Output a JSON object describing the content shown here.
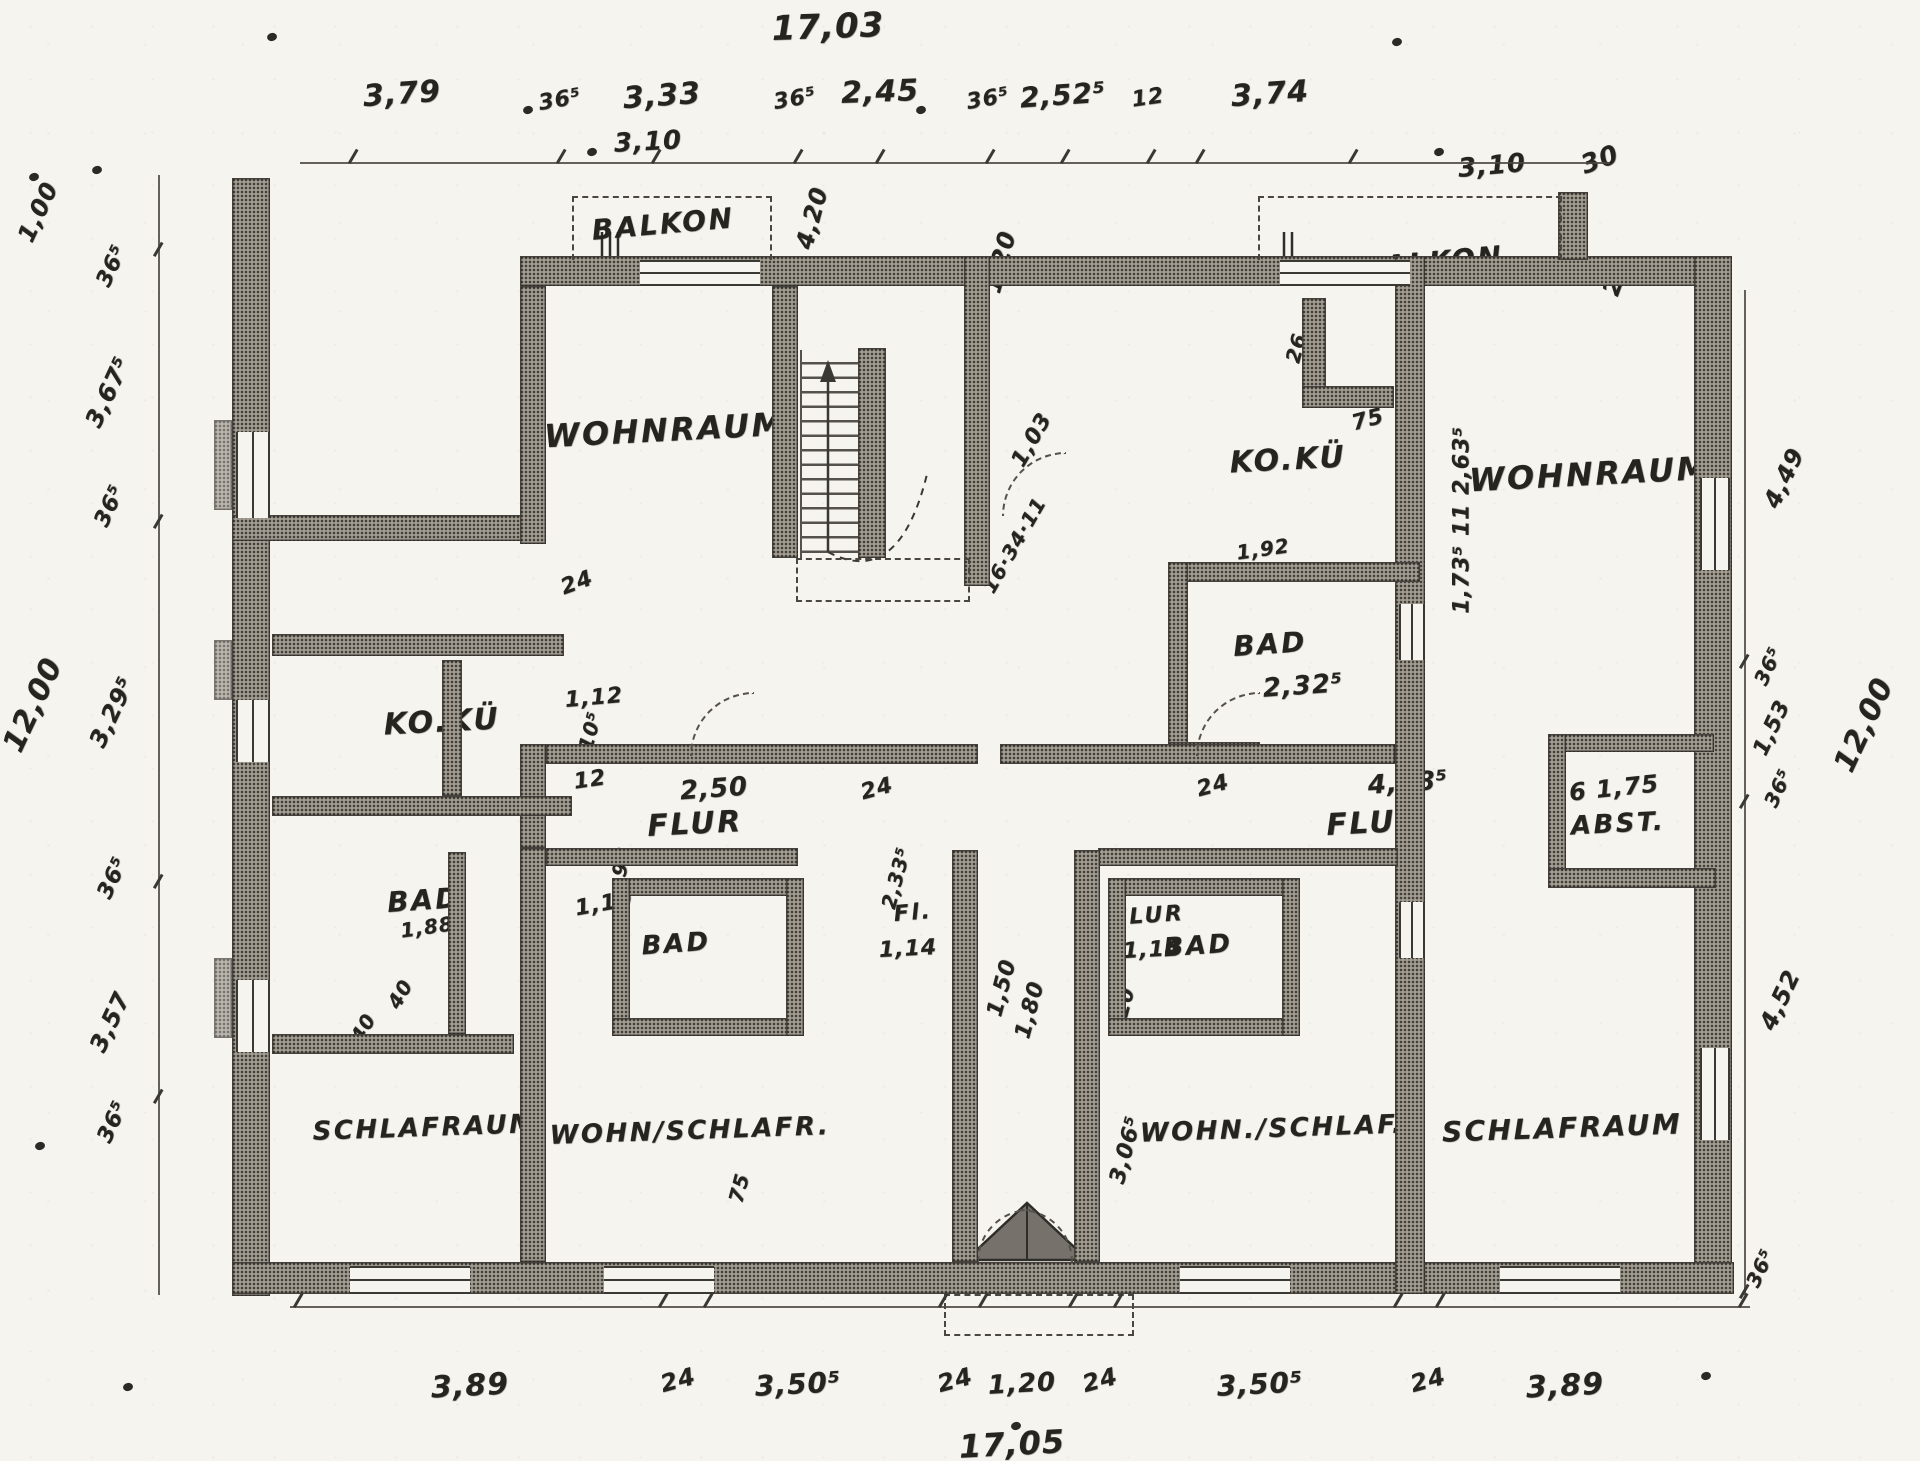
{
  "colors": {
    "ink": "#26241f",
    "paper": "#f6f4ef",
    "wall_fill": "#a39d92"
  },
  "plan": {
    "overall_width_top": "17,03",
    "overall_width_bottom": "17,05",
    "overall_depth_left": "12,00",
    "overall_depth_right": "12,00"
  },
  "rooms": [
    {
      "name": "room-label-balkon-left",
      "text": "BALKON",
      "x": 663,
      "y": 224,
      "fs": 28,
      "rot": -5
    },
    {
      "name": "room-label-balkon-right",
      "text": "BALKON",
      "x": 1432,
      "y": 262,
      "fs": 28,
      "rot": -5
    },
    {
      "name": "room-label-wohnraum-left",
      "text": "WOHNRAUM",
      "x": 665,
      "y": 430,
      "fs": 32,
      "rot": -3
    },
    {
      "name": "room-label-ko-ku-right",
      "text": "KO.KÜ",
      "x": 1288,
      "y": 460,
      "fs": 30,
      "rot": -3
    },
    {
      "name": "room-label-wohnraum-right",
      "text": "WOHNRAUM",
      "x": 1590,
      "y": 474,
      "fs": 32,
      "rot": -3
    },
    {
      "name": "room-label-ko-ku-left",
      "text": "KO.KÜ",
      "x": 442,
      "y": 722,
      "fs": 30,
      "rot": -3
    },
    {
      "name": "room-label-bad-right",
      "text": "BAD",
      "x": 1270,
      "y": 644,
      "fs": 28,
      "rot": -4
    },
    {
      "name": "room-label-bad-left",
      "text": "BAD",
      "x": 424,
      "y": 900,
      "fs": 28,
      "rot": -4
    },
    {
      "name": "room-label-flur-left",
      "text": "FLUR",
      "x": 695,
      "y": 824,
      "fs": 30,
      "rot": -3
    },
    {
      "name": "room-label-flur-right",
      "text": "FLUR",
      "x": 1374,
      "y": 823,
      "fs": 30,
      "rot": -3
    },
    {
      "name": "room-label-abst",
      "text": "ABST.",
      "x": 1618,
      "y": 824,
      "fs": 26,
      "rot": -3
    },
    {
      "name": "room-label-bad-lower-left",
      "text": "BAD",
      "x": 676,
      "y": 944,
      "fs": 26,
      "rot": -4
    },
    {
      "name": "room-label-bad-lower-right",
      "text": "BAD",
      "x": 1198,
      "y": 946,
      "fs": 26,
      "rot": -4
    },
    {
      "name": "room-label-flur-small-left",
      "text": "Fl.",
      "x": 913,
      "y": 913,
      "fs": 22,
      "rot": -5
    },
    {
      "name": "room-label-flur-small-right",
      "text": "FLUR",
      "x": 1148,
      "y": 916,
      "fs": 22,
      "rot": -4
    },
    {
      "name": "room-label-schlafraum-left",
      "text": "SCHLAFRAUM",
      "x": 425,
      "y": 1128,
      "fs": 26,
      "rot": -2
    },
    {
      "name": "room-label-wohn-schlafr",
      "text": "WOHN/SCHLAFR.",
      "x": 690,
      "y": 1131,
      "fs": 26,
      "rot": -2
    },
    {
      "name": "room-label-wohn-schlaf",
      "text": "WOHN./SCHLAF.",
      "x": 1272,
      "y": 1129,
      "fs": 26,
      "rot": -2
    },
    {
      "name": "room-label-schlafraum-right",
      "text": "SCHLAFRAUM",
      "x": 1562,
      "y": 1128,
      "fs": 28,
      "rot": -2
    }
  ],
  "dimensions": [
    {
      "name": "dim-top-3-79",
      "text": "3,79",
      "x": 402,
      "y": 94,
      "fs": 30,
      "rot": -4
    },
    {
      "name": "dim-top-36-5-a",
      "text": "36⁵",
      "x": 560,
      "y": 100,
      "fs": 22,
      "rot": -10
    },
    {
      "name": "dim-top-3-33",
      "text": "3,33",
      "x": 662,
      "y": 96,
      "fs": 30,
      "rot": -4
    },
    {
      "name": "dim-top-36-5-b",
      "text": "36⁵",
      "x": 795,
      "y": 99,
      "fs": 22,
      "rot": -10
    },
    {
      "name": "dim-top-2-45",
      "text": "2,45",
      "x": 880,
      "y": 92,
      "fs": 30,
      "rot": -2
    },
    {
      "name": "dim-top-36-5-c",
      "text": "36⁵",
      "x": 988,
      "y": 99,
      "fs": 22,
      "rot": -10
    },
    {
      "name": "dim-top-2-52-5",
      "text": "2,52⁵",
      "x": 1063,
      "y": 95,
      "fs": 28,
      "rot": -4
    },
    {
      "name": "dim-top-12",
      "text": "12",
      "x": 1148,
      "y": 98,
      "fs": 22,
      "rot": -8
    },
    {
      "name": "dim-top-3-74",
      "text": "3,74",
      "x": 1270,
      "y": 94,
      "fs": 30,
      "rot": -4
    },
    {
      "name": "dim-balkon-left-3-10",
      "text": "3,10",
      "x": 648,
      "y": 142,
      "fs": 26,
      "rot": -3
    },
    {
      "name": "dim-balkon-right-3-10",
      "text": "3,10",
      "x": 1492,
      "y": 166,
      "fs": 26,
      "rot": -5
    },
    {
      "name": "dim-balkon-right-30",
      "text": "30",
      "x": 1600,
      "y": 160,
      "fs": 26,
      "rot": -20
    },
    {
      "name": "dim-right-1-30",
      "text": "1,30.",
      "x": 1568,
      "y": 247,
      "fs": 24,
      "rot": -70
    },
    {
      "name": "dim-right-22",
      "text": "22",
      "x": 1616,
      "y": 278,
      "fs": 24,
      "rot": -70
    },
    {
      "name": "dim-4-20",
      "text": "4,20",
      "x": 812,
      "y": 218,
      "fs": 24,
      "rot": -75
    },
    {
      "name": "dim-1-20-top",
      "text": "1,20",
      "x": 1000,
      "y": 262,
      "fs": 24,
      "rot": -75
    },
    {
      "name": "dim-left-1-00",
      "text": "1,00",
      "x": 38,
      "y": 212,
      "fs": 24,
      "rot": -65
    },
    {
      "name": "dim-left-36-5-a",
      "text": "36⁵",
      "x": 112,
      "y": 266,
      "fs": 22,
      "rot": -65
    },
    {
      "name": "dim-left-3-67-5",
      "text": "3,67⁵",
      "x": 108,
      "y": 392,
      "fs": 24,
      "rot": -65
    },
    {
      "name": "dim-left-36-5-b",
      "text": "36⁵",
      "x": 110,
      "y": 506,
      "fs": 22,
      "rot": -65
    },
    {
      "name": "dim-left-3-29-5",
      "text": "3,29⁵",
      "x": 112,
      "y": 712,
      "fs": 24,
      "rot": -65
    },
    {
      "name": "dim-left-36-5-c",
      "text": "36⁵",
      "x": 113,
      "y": 878,
      "fs": 22,
      "rot": -65
    },
    {
      "name": "dim-left-3-57",
      "text": "3,57",
      "x": 110,
      "y": 1022,
      "fs": 24,
      "rot": -65
    },
    {
      "name": "dim-left-36-5-d",
      "text": "36⁵",
      "x": 113,
      "y": 1122,
      "fs": 22,
      "rot": -65
    },
    {
      "name": "dim-right-4-49",
      "text": "4,49",
      "x": 1784,
      "y": 478,
      "fs": 24,
      "rot": -65
    },
    {
      "name": "dim-right-36-5-a",
      "text": "36⁵",
      "x": 1768,
      "y": 666,
      "fs": 20,
      "rot": -65
    },
    {
      "name": "dim-right-1-53",
      "text": "1,53",
      "x": 1772,
      "y": 728,
      "fs": 22,
      "rot": -65
    },
    {
      "name": "dim-right-36-5-b",
      "text": "36⁵",
      "x": 1778,
      "y": 788,
      "fs": 20,
      "rot": -65
    },
    {
      "name": "dim-right-4-52",
      "text": "4,52",
      "x": 1780,
      "y": 1000,
      "fs": 24,
      "rot": -65
    },
    {
      "name": "dim-right-36-5-c",
      "text": "36⁵",
      "x": 1760,
      "y": 1268,
      "fs": 20,
      "rot": -65
    },
    {
      "name": "dim-wohnraum-right-chain",
      "text": "1,73⁵  11  2,63⁵",
      "x": 1462,
      "y": 520,
      "fs": 22,
      "rot": -90
    },
    {
      "name": "dim-bottom-3-89-left",
      "text": "3,89",
      "x": 470,
      "y": 1386,
      "fs": 30,
      "rot": -3
    },
    {
      "name": "dim-bottom-24-a",
      "text": "24",
      "x": 678,
      "y": 1380,
      "fs": 24,
      "rot": -15
    },
    {
      "name": "dim-bottom-3-50-5-left",
      "text": "3,50⁵",
      "x": 798,
      "y": 1384,
      "fs": 28,
      "rot": -3
    },
    {
      "name": "dim-bottom-24-b",
      "text": "24",
      "x": 955,
      "y": 1380,
      "fs": 24,
      "rot": -15
    },
    {
      "name": "dim-bottom-1-20",
      "text": "1,20",
      "x": 1022,
      "y": 1384,
      "fs": 26,
      "rot": -3
    },
    {
      "name": "dim-bottom-24-c",
      "text": "24",
      "x": 1100,
      "y": 1380,
      "fs": 24,
      "rot": -15
    },
    {
      "name": "dim-bottom-3-50-5-right",
      "text": "3,50⁵",
      "x": 1260,
      "y": 1384,
      "fs": 28,
      "rot": -3
    },
    {
      "name": "dim-bottom-24-d",
      "text": "24",
      "x": 1428,
      "y": 1380,
      "fs": 24,
      "rot": -15
    },
    {
      "name": "dim-bottom-3-89-right",
      "text": "3,89",
      "x": 1565,
      "y": 1386,
      "fs": 30,
      "rot": -3
    },
    {
      "name": "dim-leftwing-24",
      "text": "24",
      "x": 577,
      "y": 583,
      "fs": 22,
      "rot": -20
    },
    {
      "name": "dim-koku-left-1-12",
      "text": "1,12",
      "x": 594,
      "y": 698,
      "fs": 22,
      "rot": -5
    },
    {
      "name": "dim-koku-left-10-5",
      "text": "10⁵",
      "x": 590,
      "y": 731,
      "fs": 20,
      "rot": -75
    },
    {
      "name": "dim-koku-left-12",
      "text": "12",
      "x": 590,
      "y": 780,
      "fs": 22,
      "rot": -8
    },
    {
      "name": "dim-flur-left-95",
      "text": "95",
      "x": 622,
      "y": 862,
      "fs": 20,
      "rot": -75
    },
    {
      "name": "dim-flur-left-1-10",
      "text": "1,10",
      "x": 604,
      "y": 904,
      "fs": 22,
      "rot": -10
    },
    {
      "name": "dim-bad-left-40-a",
      "text": "40",
      "x": 400,
      "y": 994,
      "fs": 20,
      "rot": -60
    },
    {
      "name": "dim-bad-left-40-b",
      "text": "40",
      "x": 363,
      "y": 1028,
      "fs": 20,
      "rot": -60
    },
    {
      "name": "dim-bad-left-1-88",
      "text": "1,88",
      "x": 427,
      "y": 927,
      "fs": 20,
      "rot": -8
    },
    {
      "name": "dim-flur-left-2-50",
      "text": "2,50",
      "x": 714,
      "y": 789,
      "fs": 26,
      "rot": -4
    },
    {
      "name": "dim-flur-left-24",
      "text": "24",
      "x": 877,
      "y": 789,
      "fs": 22,
      "rot": -15
    },
    {
      "name": "dim-center-2-33-5",
      "text": "2,33⁵",
      "x": 896,
      "y": 878,
      "fs": 20,
      "rot": -75
    },
    {
      "name": "dim-fl-left-1-14",
      "text": "1,14",
      "x": 908,
      "y": 949,
      "fs": 22,
      "rot": -3
    },
    {
      "name": "dim-entry-1-50",
      "text": "1,50",
      "x": 1002,
      "y": 988,
      "fs": 22,
      "rot": -75
    },
    {
      "name": "dim-entry-1-80",
      "text": "1,80",
      "x": 1030,
      "y": 1010,
      "fs": 22,
      "rot": -75
    },
    {
      "name": "dim-entry-75",
      "text": "75",
      "x": 739,
      "y": 1188,
      "fs": 20,
      "rot": -75
    },
    {
      "name": "dim-flur-right-1-14",
      "text": "1,14",
      "x": 1152,
      "y": 950,
      "fs": 22,
      "rot": -3
    },
    {
      "name": "dim-entry-20",
      "text": "20",
      "x": 1124,
      "y": 1002,
      "fs": 20,
      "rot": -75
    },
    {
      "name": "dim-wall-3-06-5",
      "text": "3,06⁵",
      "x": 1126,
      "y": 1150,
      "fs": 22,
      "rot": -75
    },
    {
      "name": "dim-koku-right-26",
      "text": "26",
      "x": 1296,
      "y": 348,
      "fs": 20,
      "rot": -75
    },
    {
      "name": "dim-koku-right-75",
      "text": "75",
      "x": 1368,
      "y": 420,
      "fs": 22,
      "rot": -15
    },
    {
      "name": "dim-koku-right-1-92",
      "text": "1,92",
      "x": 1263,
      "y": 549,
      "fs": 20,
      "rot": -8
    },
    {
      "name": "dim-bad-right-2-32-5",
      "text": "2,32⁵",
      "x": 1303,
      "y": 686,
      "fs": 26,
      "rot": -4
    },
    {
      "name": "dim-flur-right-24",
      "text": "24",
      "x": 1213,
      "y": 786,
      "fs": 22,
      "rot": -15
    },
    {
      "name": "dim-flur-right-4-48-5",
      "text": "4,48⁵",
      "x": 1408,
      "y": 783,
      "fs": 26,
      "rot": -4
    },
    {
      "name": "dim-abst-6-1-75",
      "text": "6 1,75",
      "x": 1614,
      "y": 788,
      "fs": 24,
      "rot": -6
    },
    {
      "name": "stair-note-1-03",
      "text": "1,03",
      "x": 1032,
      "y": 440,
      "fs": 22,
      "rot": -60
    },
    {
      "name": "stair-note-16-34-11",
      "text": "16·34·11",
      "x": 1014,
      "y": 545,
      "fs": 20,
      "rot": -60
    }
  ],
  "dots": [
    {
      "x": 272,
      "y": 37
    },
    {
      "x": 1397,
      "y": 42
    },
    {
      "x": 34,
      "y": 177
    },
    {
      "x": 97,
      "y": 170
    },
    {
      "x": 528,
      "y": 110
    },
    {
      "x": 921,
      "y": 110
    },
    {
      "x": 592,
      "y": 152
    },
    {
      "x": 1439,
      "y": 152
    },
    {
      "x": 40,
      "y": 1146
    },
    {
      "x": 128,
      "y": 1387
    },
    {
      "x": 1706,
      "y": 1376
    },
    {
      "x": 1016,
      "y": 1426
    }
  ]
}
